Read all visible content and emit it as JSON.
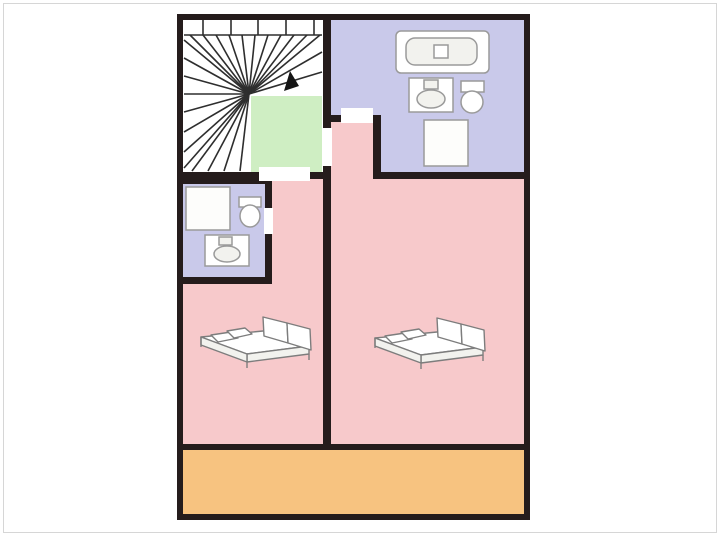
{
  "image": {
    "kind": "floor-plan",
    "description": "Upper-storey apartment floor plan with winder staircase, landing, two bathrooms, two bedrooms with double beds, and a balcony strip",
    "contains_text": false
  },
  "colors": {
    "background": "#ffffff",
    "frame_border": "#d6d6d6",
    "wall": "#251c1c",
    "stair_floor": "#ffffff",
    "stair_line": "#2e2e2e",
    "landing": "#cfeec3",
    "bathroom": "#c9c9ea",
    "bedroom": "#f7c9cb",
    "balcony": "#f7c380",
    "door_opening": "#ffffff",
    "fixture_fill": "#ffffff",
    "fixture_fill_dim": "#f2f2ee",
    "fixture_stroke": "#9a9a9a",
    "bed_stroke": "#7d7d7d",
    "arrow": "#141414"
  },
  "rooms": [
    {
      "id": "staircase",
      "kind": "winder-staircase"
    },
    {
      "id": "landing",
      "kind": "landing"
    },
    {
      "id": "bathroom-main",
      "kind": "bathroom",
      "fixtures": [
        "bathtub",
        "sink",
        "toilet",
        "shower"
      ]
    },
    {
      "id": "bathroom-small",
      "kind": "bathroom",
      "fixtures": [
        "shower",
        "toilet",
        "sink"
      ]
    },
    {
      "id": "bedroom-left",
      "kind": "bedroom",
      "fixtures": [
        "double-bed"
      ]
    },
    {
      "id": "bedroom-right",
      "kind": "bedroom",
      "fixtures": [
        "double-bed"
      ]
    },
    {
      "id": "balcony",
      "kind": "balcony"
    }
  ],
  "doors": [
    {
      "id": "landing-to-left-hall"
    },
    {
      "id": "landing-to-right-bedroom"
    },
    {
      "id": "main-bathroom-door"
    },
    {
      "id": "small-bathroom-door"
    }
  ]
}
